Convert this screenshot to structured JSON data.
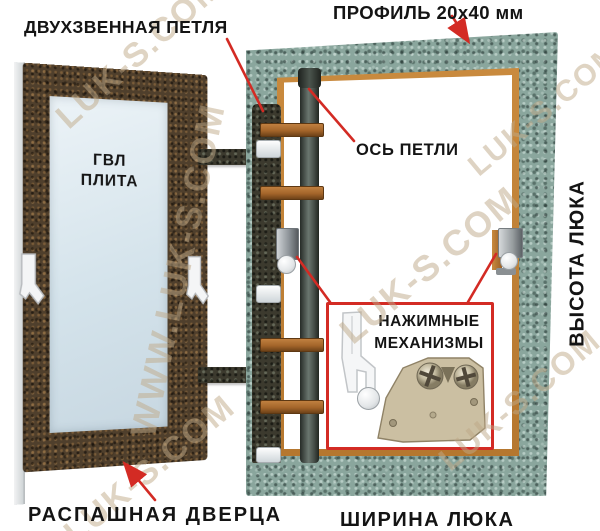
{
  "colors": {
    "annotation_red": "#d32b24",
    "label_black": "#141414",
    "frame_green": "#8aa69d",
    "door_bronze": "#4f3f2c",
    "profile_orange": "#b5772f",
    "copper_link": "#a4652a",
    "gvl_panel_blue": "#dce8ef",
    "watermark_tan": "#bfa988",
    "mechanism_beige": "#cbbfa2"
  },
  "annotations": {
    "double_link_hinge": "ДВУХЗВЕННАЯ ПЕТЛЯ",
    "profile": "ПРОФИЛЬ 20х40 мм",
    "gvl_plate_line1": "ГВЛ",
    "gvl_plate_line2": "ПЛИТА",
    "hinge_axis": "ОСЬ ПЕТЛИ",
    "hatch_height": "ВЫСОТА ЛЮКА",
    "push_mech_line1": "НАЖИМНЫЕ",
    "push_mech_line2": "МЕХАНИЗМЫ",
    "swing_door": "РАСПАШНАЯ ДВЕРЦА",
    "hatch_width": "ШИРИНА ЛЮКА"
  },
  "watermarks": [
    "LUK-S.COM",
    "WWW.LUK-S.COM",
    "LUK-S.COM",
    "LUK-S.COM",
    "LUK-S.COM",
    "LUK-S.COM"
  ]
}
